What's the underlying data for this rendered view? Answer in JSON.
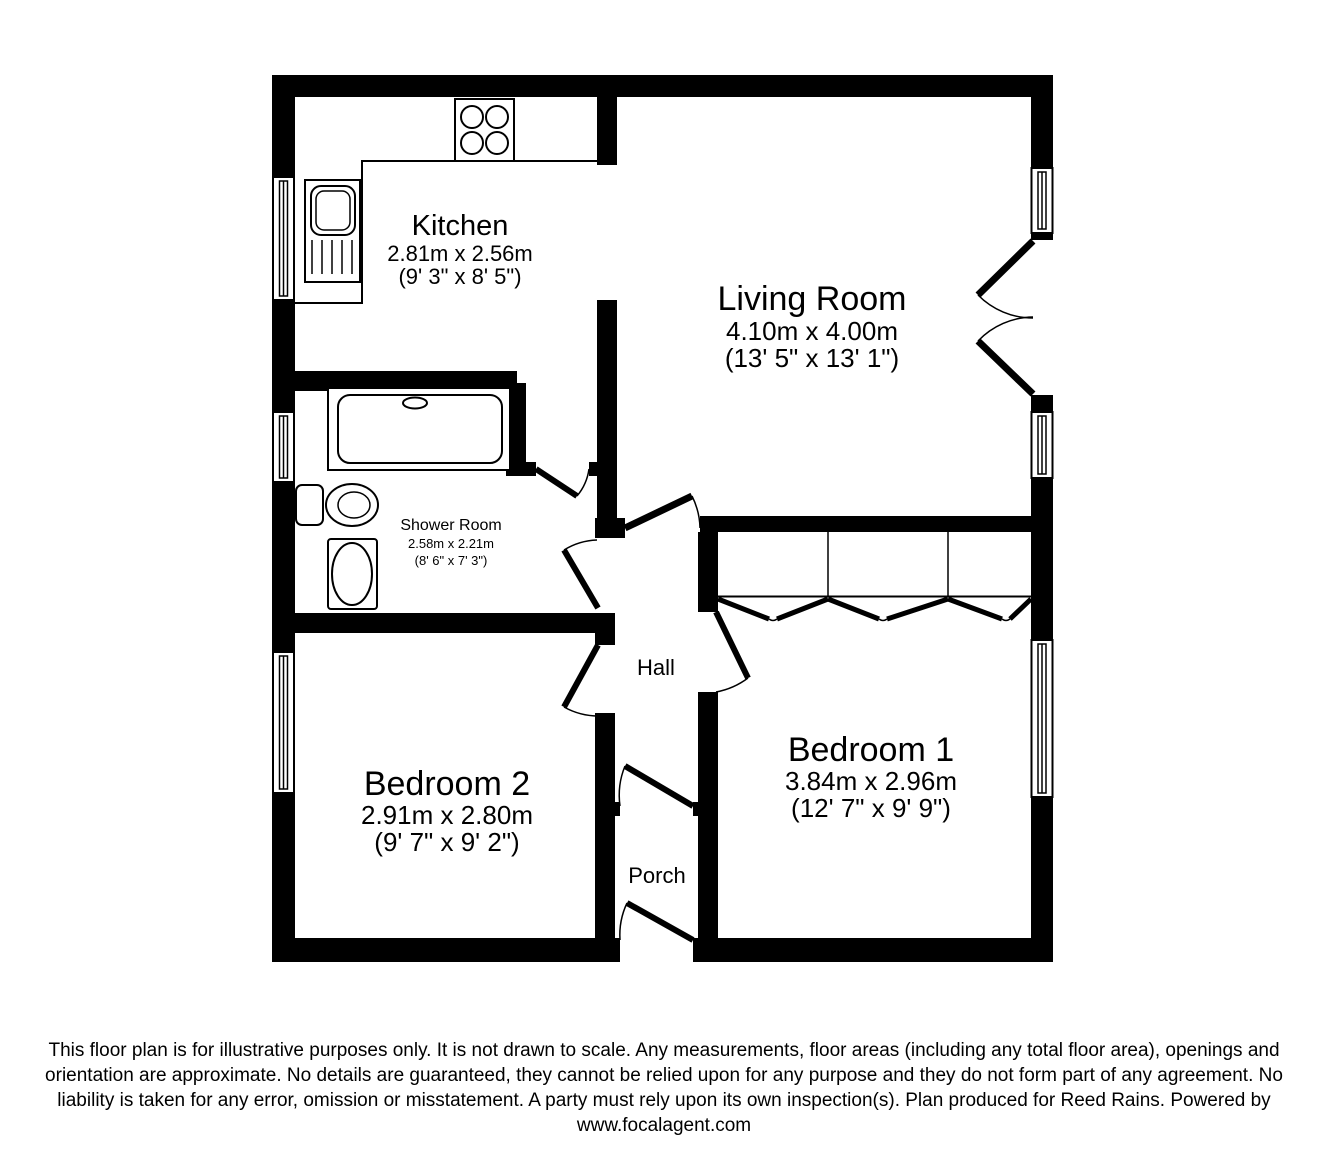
{
  "page": {
    "background": "#ffffff",
    "line_color": "#000000"
  },
  "plan": {
    "rooms": {
      "kitchen": {
        "name": "Kitchen",
        "metric": "2.81m x 2.56m",
        "imperial": "(9' 3\" x 8' 5\")"
      },
      "living_room": {
        "name": "Living Room",
        "metric": "4.10m x 4.00m",
        "imperial": "(13' 5\" x 13' 1\")"
      },
      "shower_room": {
        "name": "Shower Room",
        "metric": "2.58m x 2.21m",
        "imperial": "(8' 6\" x 7' 3\")"
      },
      "hall": {
        "name": "Hall"
      },
      "porch": {
        "name": "Porch"
      },
      "bedroom_1": {
        "name": "Bedroom 1",
        "metric": "3.84m x 2.96m",
        "imperial": "(12' 7\" x 9' 9\")"
      },
      "bedroom_2": {
        "name": "Bedroom 2",
        "metric": "2.91m x 2.80m",
        "imperial": "(9' 7\" x 9' 2\")"
      }
    },
    "fixtures": [
      "hob-icon",
      "sink-drainer-icon",
      "shower-tray-icon",
      "toilet-icon",
      "wash-basin-icon",
      "built-in-wardrobe",
      "window-symbol",
      "door-swing-symbol"
    ]
  },
  "disclaimer": {
    "lines": [
      "This floor plan is for illustrative purposes only. It is not drawn to scale. Any measurements, floor areas (including any total floor area), openings and",
      "orientation are approximate. No details are guaranteed, they cannot be relied upon for any purpose and they do not form part of any agreement. No",
      "liability is taken for any error, omission or misstatement. A party must rely upon its own inspection(s). Plan produced for Reed Rains. Powered by",
      "www.focalagent.com"
    ]
  }
}
